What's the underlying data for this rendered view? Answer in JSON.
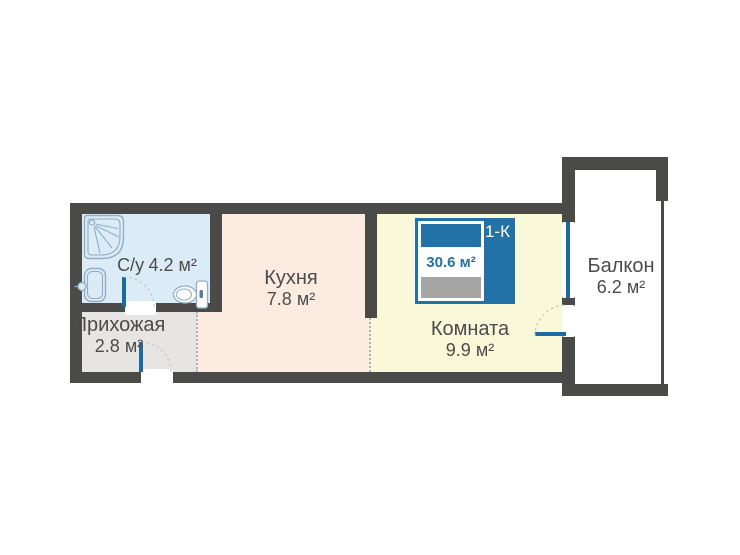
{
  "badge": {
    "type_label": "1-К",
    "total_area": "30.6 м²"
  },
  "rooms": {
    "bathroom": {
      "name": "С/у",
      "area": "4.2 м²"
    },
    "hallway": {
      "name": "Прихожая",
      "area": "2.8 м²"
    },
    "kitchen": {
      "name": "Кухня",
      "area": "7.8 м²"
    },
    "living": {
      "name": "Комната",
      "area": "9.9 м²"
    },
    "balcony": {
      "name": "Балкон",
      "area": "6.2 м²"
    }
  },
  "fixtures": {
    "bathroom": [
      "shower-icon",
      "sink-icon",
      "toilet-icon"
    ],
    "badge": "bed-icon"
  },
  "colors": {
    "wall": "#4a4a48",
    "bathroom_fill": "#dcecf7",
    "hallway_fill": "#e6e5e3",
    "kitchen_fill": "#fcebe0",
    "living_fill": "#f9f8d8",
    "balcony_fill": "#ffffff",
    "accent_blue": "#1b6ba2",
    "badge_blue": "#2272a8",
    "badge_gray": "#a5a5a5",
    "text": "#4c4c4c",
    "fixture": "#92aec4",
    "swing_arc": "#c6c6c6",
    "dotted": "#b3b3b3"
  }
}
